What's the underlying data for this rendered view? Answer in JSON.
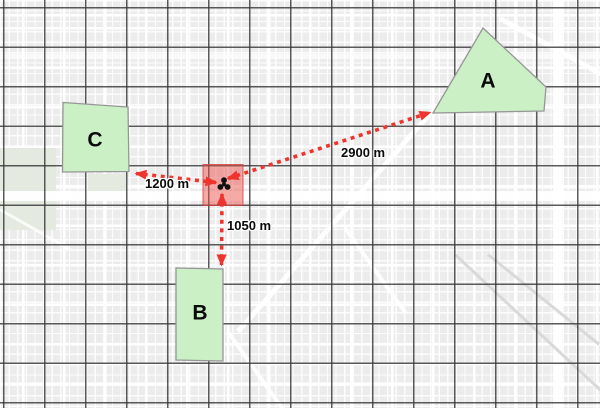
{
  "map": {
    "zones": [
      {
        "id": "A",
        "label": "A"
      },
      {
        "id": "B",
        "label": "B"
      },
      {
        "id": "C",
        "label": "C"
      }
    ],
    "incident": {
      "icon": "radiation-icon"
    },
    "measurements": [
      {
        "zone": "A",
        "distance": "2900 m"
      },
      {
        "zone": "B",
        "distance": "1050 m"
      },
      {
        "zone": "C",
        "distance": "1200 m"
      }
    ],
    "colors": {
      "zone_fill": "#cbf0c6",
      "zone_border": "#969696",
      "arrow_red": "#ee342c",
      "incident_red": "#ec4e48",
      "grid_line": "#373737",
      "basemap": "#ececec"
    }
  }
}
